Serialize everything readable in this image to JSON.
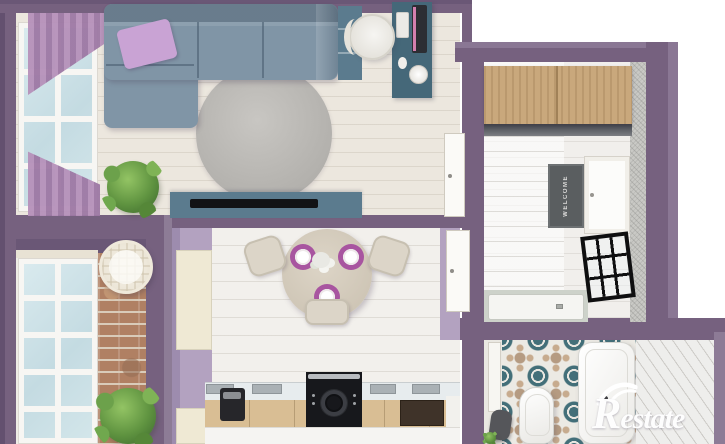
{
  "scene": {
    "type": "apartment-floor-plan-3d-render",
    "view": "top-down"
  },
  "watermark": {
    "brand": "Restate"
  },
  "entry": {
    "doormat_text": "WELCOME"
  },
  "palette": {
    "wall": "#76617f",
    "lilac": "#b3a2c0",
    "sofa": "#8095a6",
    "pillow": "#c9a3d4",
    "console": "#5b7b8e",
    "desk": "#456879",
    "wood": "#c9a87c",
    "mat": "#5a5e60",
    "cabinet": "#efe9d4",
    "cabface": "#d9be94",
    "counter": "#e7ecee",
    "placemat": "#a855a0",
    "stove": "#17181c",
    "tileteal": "#436f79",
    "tiletan": "#b59b82",
    "brick": "#b08063"
  },
  "rooms": {
    "living_room": {
      "items": [
        "corner-sofa",
        "accent-pillow",
        "round-rug",
        "tv-console",
        "tv",
        "floor-plant",
        "window",
        "curtains",
        "bookshelf"
      ]
    },
    "workspace": {
      "items": [
        "desk",
        "monitor",
        "keyboard",
        "mouse",
        "desk-lamp",
        "swivel-chair",
        "door"
      ]
    },
    "entry_hall": {
      "items": [
        "wardrobe",
        "doormat",
        "front-door",
        "shower-screen",
        "shower-tray",
        "textured-wall"
      ]
    },
    "kitchen": {
      "items": [
        "dining-table",
        "place-settings",
        "flower-centerpiece",
        "dining-chairs",
        "tall-cabinet",
        "counter",
        "stove-oven",
        "coffee-maker",
        "door"
      ]
    },
    "bathroom": {
      "items": [
        "patterned-tile-floor",
        "toilet",
        "bathtub",
        "laundry-basket",
        "door"
      ]
    },
    "balcony": {
      "items": [
        "panoramic-window",
        "wicker-chair",
        "brick-wall",
        "plant"
      ]
    }
  }
}
